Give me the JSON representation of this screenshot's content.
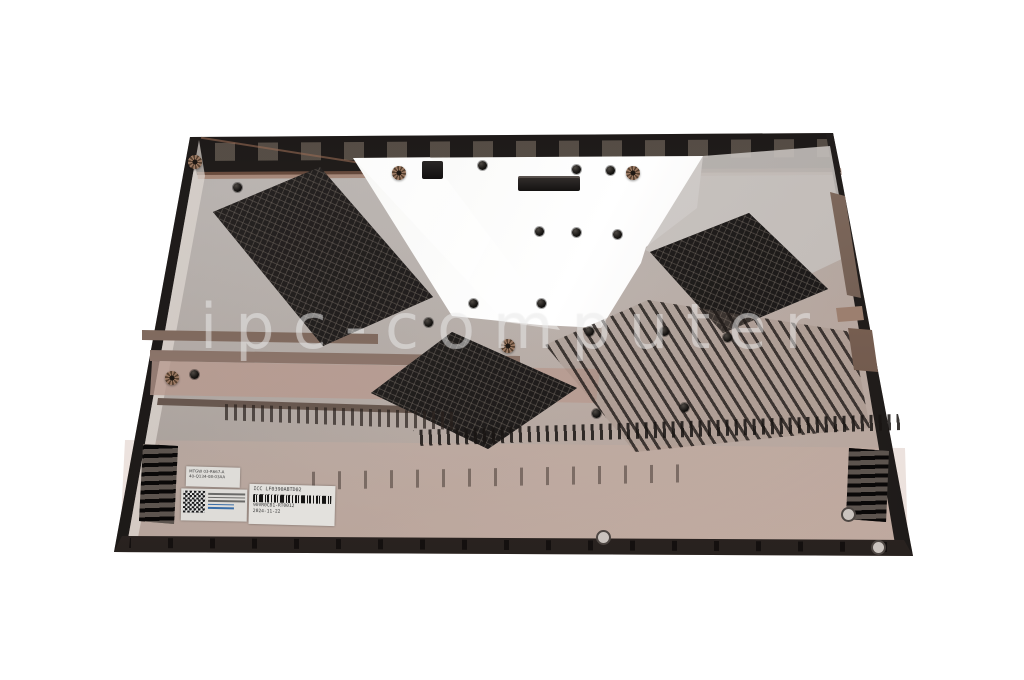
{
  "photo": {
    "subject": "laptop-bottom-case-inner-side",
    "watermark": "ipc-computer"
  },
  "stickers": {
    "code_label": {
      "line1": "MTGW 03-R667-A",
      "line2": "40-Q134-08-03AA"
    },
    "part_label": {
      "title": "ICC  LF0390ABTD02",
      "serial": "90VR0CB1-RT0012",
      "date": "2024-11-22"
    }
  },
  "colors": {
    "background": "#ffffff",
    "case_gray": "#b6b0ad",
    "copper_tint": "#b08a77",
    "vent_black": "#211e1d",
    "shield_white": "#f6f5f3"
  }
}
